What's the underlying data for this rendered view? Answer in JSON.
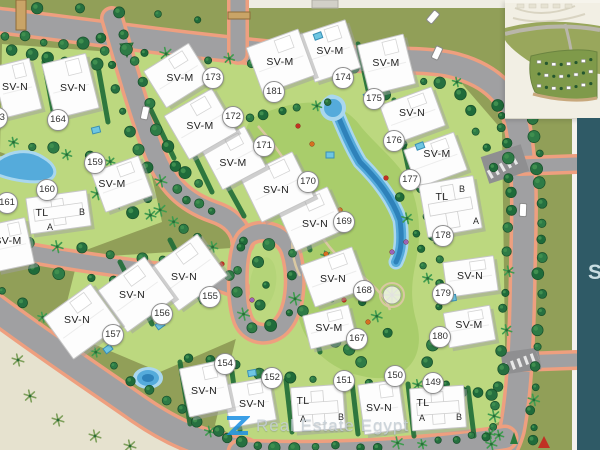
{
  "map": {
    "units": [
      {
        "no": "149",
        "type": "TL",
        "badge": [
          432,
          382
        ],
        "label": [
          423,
          403
        ],
        "subs": [
          {
            "t": "A",
            "x": 422,
            "y": 418
          },
          {
            "t": "B",
            "x": 459,
            "y": 417
          }
        ],
        "bld": [
          411,
          387,
          54,
          42,
          -4
        ]
      },
      {
        "no": "150",
        "type": "SV-N",
        "badge": [
          394,
          375
        ],
        "label": [
          379,
          408
        ],
        "bld": [
          361,
          382,
          41,
          50,
          -8
        ]
      },
      {
        "no": "151",
        "type": "TL",
        "badge": [
          343,
          380
        ],
        "label": [
          303,
          401
        ],
        "subs": [
          {
            "t": "A",
            "x": 303,
            "y": 419
          },
          {
            "t": "B",
            "x": 341,
            "y": 417
          }
        ],
        "bld": [
          292,
          386,
          52,
          44,
          -4
        ]
      },
      {
        "no": "152",
        "type": "SV-N",
        "badge": [
          271,
          377
        ],
        "label": [
          252,
          404
        ],
        "bld": [
          226,
          381,
          47,
          43,
          -10
        ]
      },
      {
        "no": "154",
        "type": "SV-N",
        "badge": [
          224,
          363
        ],
        "label": [
          204,
          391
        ],
        "bld": [
          184,
          364,
          44,
          49,
          -12
        ]
      },
      {
        "no": "155",
        "type": "SV-N",
        "badge": [
          209,
          296
        ],
        "label": [
          184,
          277
        ],
        "bld": [
          158,
          247,
          60,
          51,
          -36
        ]
      },
      {
        "no": "156",
        "type": "SV-N",
        "badge": [
          161,
          313
        ],
        "label": [
          132,
          295
        ],
        "bld": [
          107,
          269,
          58,
          51,
          -36
        ]
      },
      {
        "no": "157",
        "type": "SV-N",
        "badge": [
          112,
          334
        ],
        "label": [
          77,
          320
        ],
        "bld": [
          53,
          296,
          58,
          51,
          -36
        ]
      },
      {
        "no": "159",
        "type": "SV-M",
        "badge": [
          94,
          162
        ],
        "label": [
          112,
          184
        ],
        "bld": [
          97,
          163,
          50,
          42,
          -20
        ]
      },
      {
        "no": "160",
        "type": "TL",
        "badge": [
          46,
          189
        ],
        "label": [
          42,
          213
        ],
        "subs": [
          {
            "t": "A",
            "x": 50,
            "y": 227
          },
          {
            "t": "B",
            "x": 82,
            "y": 212
          }
        ],
        "bld": [
          28,
          194,
          61,
          36,
          -8
        ]
      },
      {
        "no": "161",
        "type": "SV-M",
        "badge": [
          6,
          202
        ],
        "label": [
          8,
          241
        ],
        "bld": [
          -8,
          221,
          38,
          47,
          -12
        ]
      },
      {
        "no": "163",
        "type": "SV-N",
        "badge": [
          -4,
          117
        ],
        "label": [
          15,
          87
        ],
        "bld": [
          -2,
          62,
          38,
          52,
          -14
        ]
      },
      {
        "no": "164",
        "type": "SV-N",
        "badge": [
          57,
          119
        ],
        "label": [
          73,
          88
        ],
        "bld": [
          48,
          58,
          45,
          56,
          -14
        ]
      },
      {
        "no": "167",
        "type": "SV-M",
        "badge": [
          356,
          338
        ],
        "label": [
          329,
          328
        ],
        "bld": [
          306,
          310,
          47,
          34,
          -14
        ]
      },
      {
        "no": "168",
        "type": "SV-N",
        "badge": [
          363,
          290
        ],
        "label": [
          333,
          279
        ],
        "bld": [
          306,
          255,
          55,
          44,
          -20
        ]
      },
      {
        "no": "169",
        "type": "SV-N",
        "badge": [
          343,
          221
        ],
        "label": [
          315,
          224
        ],
        "bld": [
          284,
          196,
          55,
          46,
          -24
        ]
      },
      {
        "no": "170",
        "type": "SV-N",
        "badge": [
          307,
          181
        ],
        "label": [
          276,
          190
        ],
        "bld": [
          248,
          162,
          58,
          50,
          -26
        ]
      },
      {
        "no": "171",
        "type": "SV-M",
        "badge": [
          263,
          145
        ],
        "label": [
          233,
          163
        ],
        "bld": [
          209,
          135,
          49,
          46,
          -28
        ]
      },
      {
        "no": "172",
        "type": "SV-M",
        "badge": [
          232,
          116
        ],
        "label": [
          200,
          126
        ],
        "bld": [
          173,
          99,
          55,
          50,
          -30
        ]
      },
      {
        "no": "173",
        "type": "SV-M",
        "badge": [
          212,
          77
        ],
        "label": [
          180,
          78
        ],
        "bld": [
          151,
          54,
          53,
          43,
          -32
        ]
      },
      {
        "no": "174",
        "type": "SV-M",
        "badge": [
          342,
          77
        ],
        "label": [
          330,
          51
        ],
        "bld": [
          306,
          26,
          48,
          50,
          -18
        ]
      },
      {
        "no": "175",
        "type": "SV-M",
        "badge": [
          373,
          98
        ],
        "label": [
          386,
          63
        ],
        "bld": [
          363,
          39,
          47,
          51,
          -14
        ]
      },
      {
        "no": "176",
        "type": "SV-N",
        "badge": [
          393,
          140
        ],
        "label": [
          412,
          113
        ],
        "bld": [
          385,
          95,
          55,
          41,
          -20
        ]
      },
      {
        "no": "177",
        "type": "SV-M",
        "badge": [
          409,
          179
        ],
        "label": [
          437,
          154
        ],
        "bld": [
          409,
          140,
          53,
          40,
          -20
        ]
      },
      {
        "no": "178",
        "type": "TL",
        "badge": [
          442,
          235
        ],
        "label": [
          442,
          197
        ],
        "subs": [
          {
            "t": "A",
            "x": 476,
            "y": 221
          },
          {
            "t": "B",
            "x": 462,
            "y": 189
          }
        ],
        "bld": [
          423,
          180,
          55,
          53,
          -10
        ]
      },
      {
        "no": "179",
        "type": "SV-N",
        "badge": [
          442,
          293
        ],
        "label": [
          470,
          276
        ],
        "bld": [
          445,
          259,
          51,
          35,
          -8
        ]
      },
      {
        "no": "180",
        "type": "SV-M",
        "badge": [
          439,
          336
        ],
        "label": [
          469,
          325
        ],
        "bld": [
          446,
          309,
          47,
          35,
          -10
        ]
      },
      {
        "no": "181",
        "type": "SV-M",
        "badge": [
          273,
          91
        ],
        "label": [
          280,
          62
        ],
        "bld": [
          253,
          37,
          55,
          49,
          -20
        ]
      }
    ]
  },
  "watermark": {
    "text": "Real Estate Egypt"
  },
  "side_panel": {
    "partial_text": "S"
  },
  "colors": {
    "olive": "#919f58",
    "parcel": "#bcd87f",
    "park": "#a9cd6b",
    "road": "#a0a0a2",
    "road_dark": "#8f8f91",
    "sidewalk": "#ee9f7f",
    "tree_dark": "#267040",
    "water_deep": "#2e82ba",
    "water_mid": "#55abdb",
    "water_light": "#a9d7ee",
    "building": "#fdfdfd",
    "teal_panel": "#2f5a66",
    "logo_blue": "#1a8fe3",
    "flag_red": "#c03024"
  }
}
